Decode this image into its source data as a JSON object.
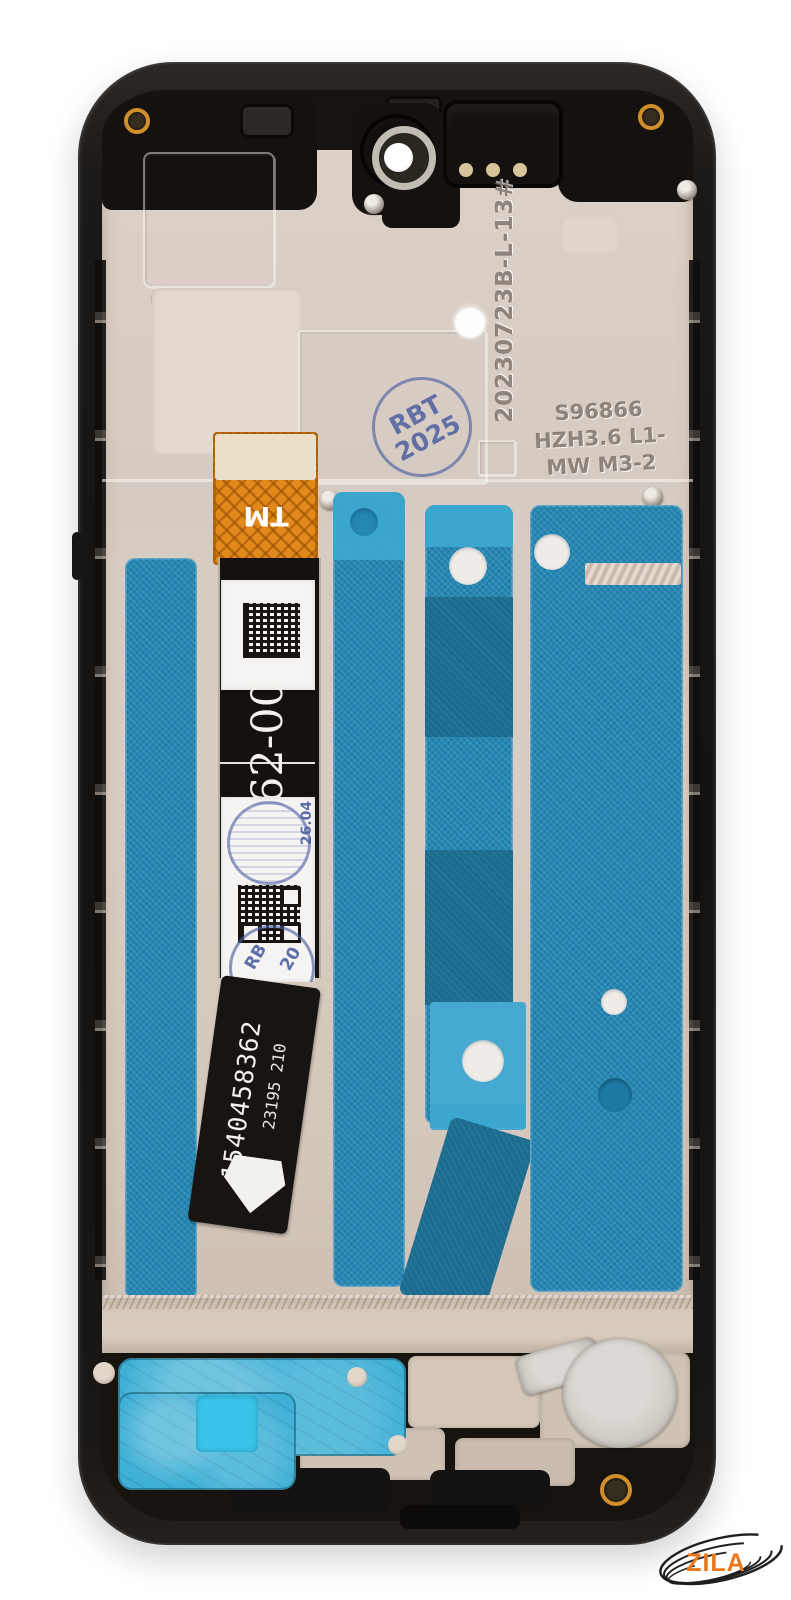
{
  "photo": {
    "subject": "Smartphone LCD display assembly with middle frame, rear view, on white background",
    "watermark": "ZILA"
  },
  "markings": {
    "engraved_date_code": "20230723B-L-13#",
    "mold_line1": "S96866",
    "mold_line2": "HZH3.6 L1-",
    "mold_line3": "MW M3-2",
    "qc_stamp_line1": "RBT",
    "qc_stamp_line2": "2025",
    "flex_tm": "TM",
    "label_code": "62-00",
    "label_stamp_date": "26.04",
    "label_stamp_partial1": "RB",
    "label_stamp_partial2": "20",
    "serial_number": "1540458362",
    "batch_code": "23195 210"
  },
  "colors": {
    "background": "#ffffff",
    "frame_black": "#1b1917",
    "plate_beige": "#d7ccc3",
    "adhesive_teal": "#2487b4",
    "adhesive_teal_dark": "#1c6c90",
    "adhesive_teal_light": "#3ba6cf",
    "gasket_cyan": "#3fb0d6",
    "flex_orange": "#e2891b",
    "flex_black": "#14110f",
    "label_white": "#f5f4f2",
    "stamp_blue": "#4d5fa2",
    "logo_orange": "#e8791c",
    "screw_gold": "#cf8f2a"
  }
}
